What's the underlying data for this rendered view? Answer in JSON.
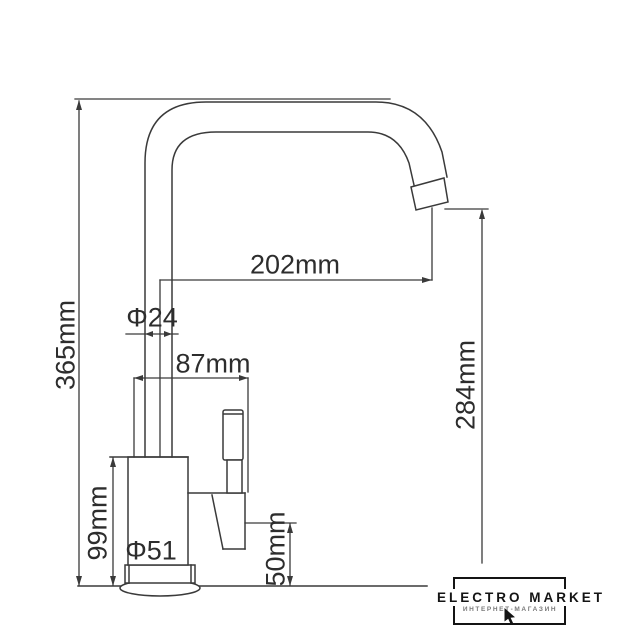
{
  "drawing": {
    "type": "kitchen-faucet dimensional drawing",
    "units": "mm"
  },
  "dimensions": {
    "total_height": {
      "label": "365mm"
    },
    "spout_reach": {
      "label": "202mm"
    },
    "spout_diameter": {
      "label": "Φ24"
    },
    "body_width": {
      "label": "87mm"
    },
    "outlet_height": {
      "label": "284mm"
    },
    "body_height": {
      "label": "99mm"
    },
    "base_diameter": {
      "label": "Φ51"
    },
    "valve_height": {
      "label": "50mm"
    }
  },
  "watermark": {
    "brand": "ELECTRO MARKET",
    "tagline": "ИНТЕРНЕТ-МАГАЗИН"
  },
  "colors": {
    "line": "#3a3a3a",
    "text": "#2d2d2d",
    "background": "#ffffff",
    "logo": "#141414",
    "tagline": "#7a7a7a"
  }
}
